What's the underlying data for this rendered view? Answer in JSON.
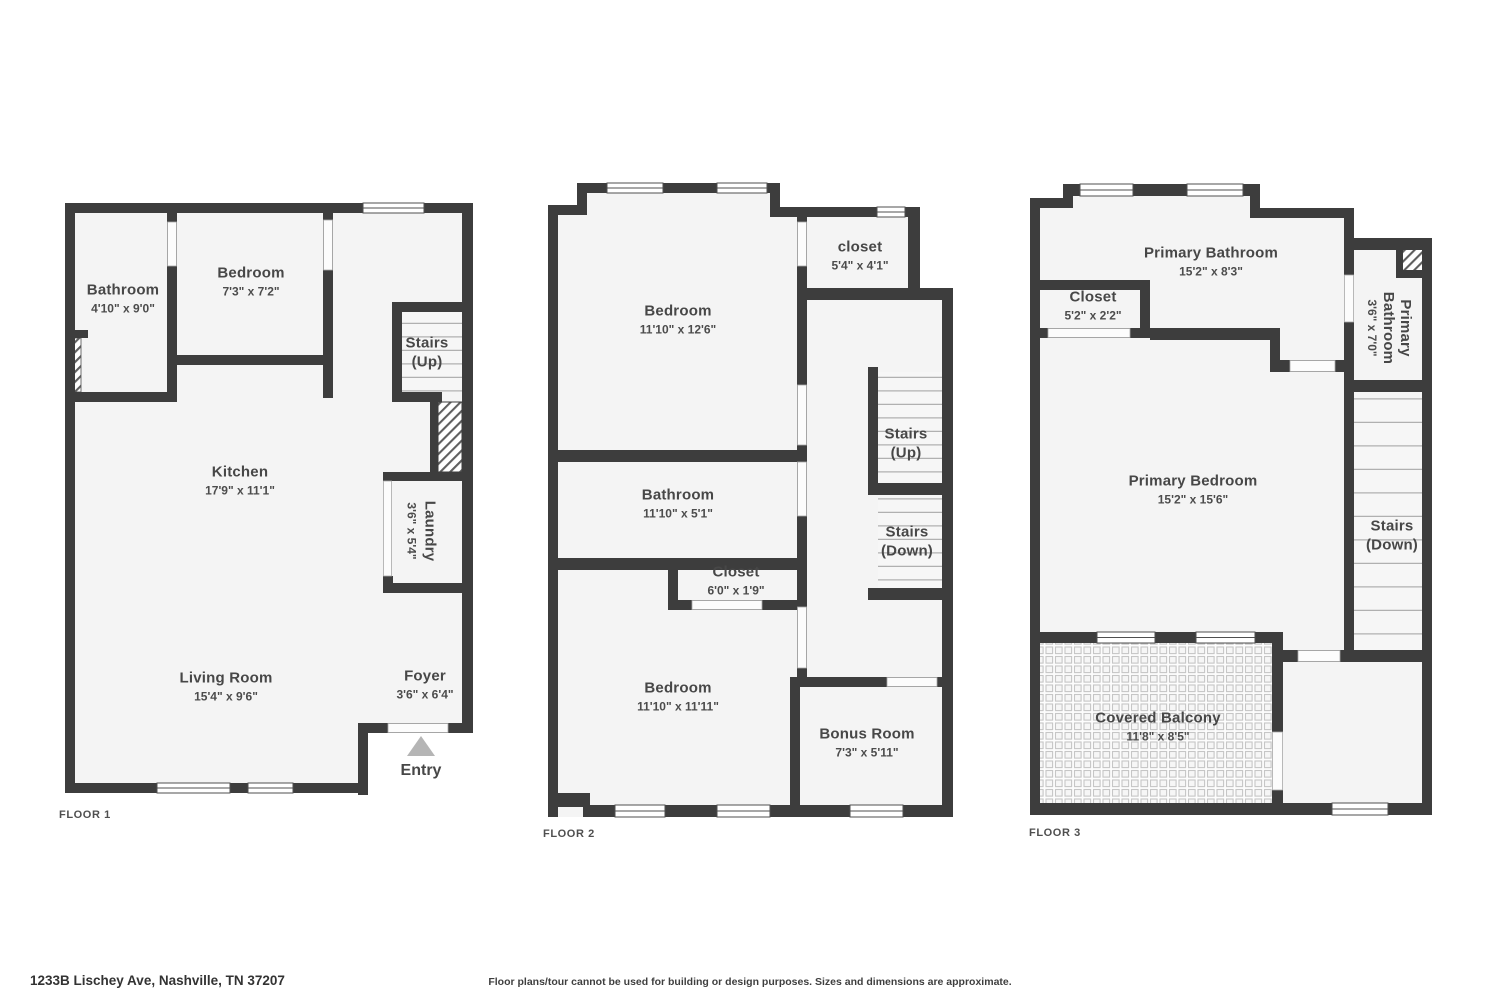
{
  "colors": {
    "wall": "#3d3d3d",
    "room_fill": "#f4f4f4",
    "label_text": "#474747",
    "entry_arrow": "#b5b5b5"
  },
  "floors": {
    "floor1": {
      "tag": "FLOOR 1",
      "rooms": {
        "bathroom": {
          "name": "Bathroom",
          "dims": "4'10\" x 9'0\""
        },
        "bedroom": {
          "name": "Bedroom",
          "dims": "7'3\" x 7'2\""
        },
        "stairs_up": {
          "name": "Stairs",
          "dims": "(Up)"
        },
        "kitchen": {
          "name": "Kitchen",
          "dims": "17'9\" x 11'1\""
        },
        "laundry": {
          "name": "Laundry",
          "dims": "3'6\" x 5'4\""
        },
        "foyer": {
          "name": "Foyer",
          "dims": "3'6\" x 6'4\""
        },
        "living_room": {
          "name": "Living Room",
          "dims": "15'4\" x 9'6\""
        },
        "entry": {
          "name": "Entry"
        }
      }
    },
    "floor2": {
      "tag": "FLOOR 2",
      "rooms": {
        "closet_small": {
          "name": "closet",
          "dims": "5'4\" x 4'1\""
        },
        "bedroom_top": {
          "name": "Bedroom",
          "dims": "11'10\" x 12'6\""
        },
        "stairs_up": {
          "name": "Stairs",
          "dims": "(Up)"
        },
        "stairs_down": {
          "name": "Stairs",
          "dims": "(Down)"
        },
        "bathroom": {
          "name": "Bathroom",
          "dims": "11'10\" x 5'1\""
        },
        "closet": {
          "name": "Closet",
          "dims": "6'0\" x 1'9\""
        },
        "bedroom_bottom": {
          "name": "Bedroom",
          "dims": "11'10\" x 11'11\""
        },
        "bonus_room": {
          "name": "Bonus Room",
          "dims": "7'3\" x 5'11\""
        }
      }
    },
    "floor3": {
      "tag": "FLOOR 3",
      "rooms": {
        "primary_bathroom": {
          "name": "Primary Bathroom",
          "dims": "15'2\" x 8'3\""
        },
        "closet": {
          "name": "Closet",
          "dims": "5'2\" x 2'2\""
        },
        "primary_bathroom_small": {
          "name": "Primary Bathroom",
          "dims": "3'6\" x 7'0\""
        },
        "primary_bedroom": {
          "name": "Primary Bedroom",
          "dims": "15'2\" x 15'6\""
        },
        "stairs_down": {
          "name": "Stairs",
          "dims": "(Down)"
        },
        "covered_balcony": {
          "name": "Covered Balcony",
          "dims": "11'8\" x 8'5\""
        }
      }
    }
  },
  "footer": {
    "address": "1233B Lischey Ave, Nashville, TN 37207",
    "disclaimer": "Floor plans/tour cannot be used for building or design purposes. Sizes and dimensions are approximate."
  }
}
